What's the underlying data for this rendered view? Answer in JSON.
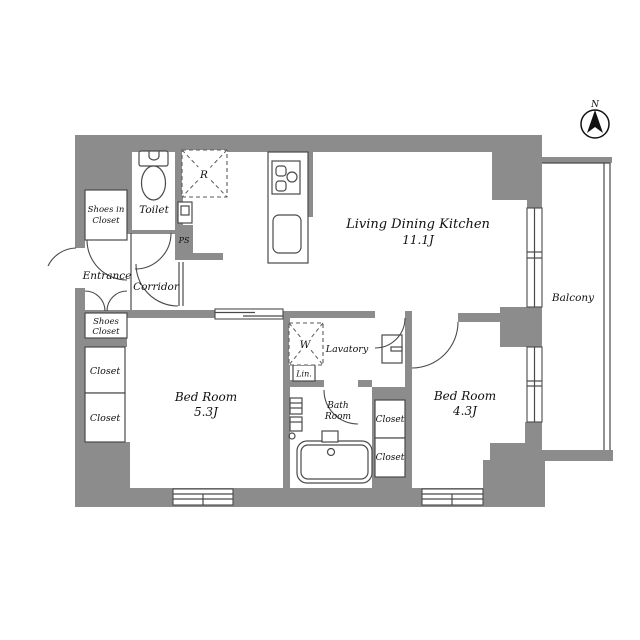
{
  "plan": {
    "compass_label": "N",
    "rooms": {
      "ldk": {
        "name": "Living Dining Kitchen",
        "area": "11.1J"
      },
      "bedroom_53": {
        "name": "Bed Room",
        "area": "5.3J"
      },
      "bedroom_43": {
        "name": "Bed Room",
        "area": "4.3J"
      },
      "balcony": {
        "name": "Balcony"
      },
      "entrance": {
        "name": "Entrance"
      },
      "corridor": {
        "name": "Corridor"
      },
      "toilet": {
        "name": "Toilet"
      },
      "lavatory": {
        "name": "Lavatory"
      },
      "bath_room": {
        "line1": "Bath",
        "line2": "Room"
      }
    },
    "storage": {
      "shoes_in_closet": {
        "line1": "Shoes in",
        "line2": "Closet"
      },
      "shoes_closet": {
        "line1": "Shoes",
        "line2": "Closet"
      },
      "closet_bed53_upper": "Closet",
      "closet_bed53_lower": "Closet",
      "closet_bed43_upper": "Closet",
      "closet_bed43_lower": "Closet",
      "linen": "Lin."
    },
    "marks": {
      "washer": "W",
      "refrigerator": "R",
      "pipe_space": "PS"
    },
    "colors": {
      "wall": "#8C8C8C",
      "line": "#4A4A4A",
      "text": "#111111"
    }
  }
}
